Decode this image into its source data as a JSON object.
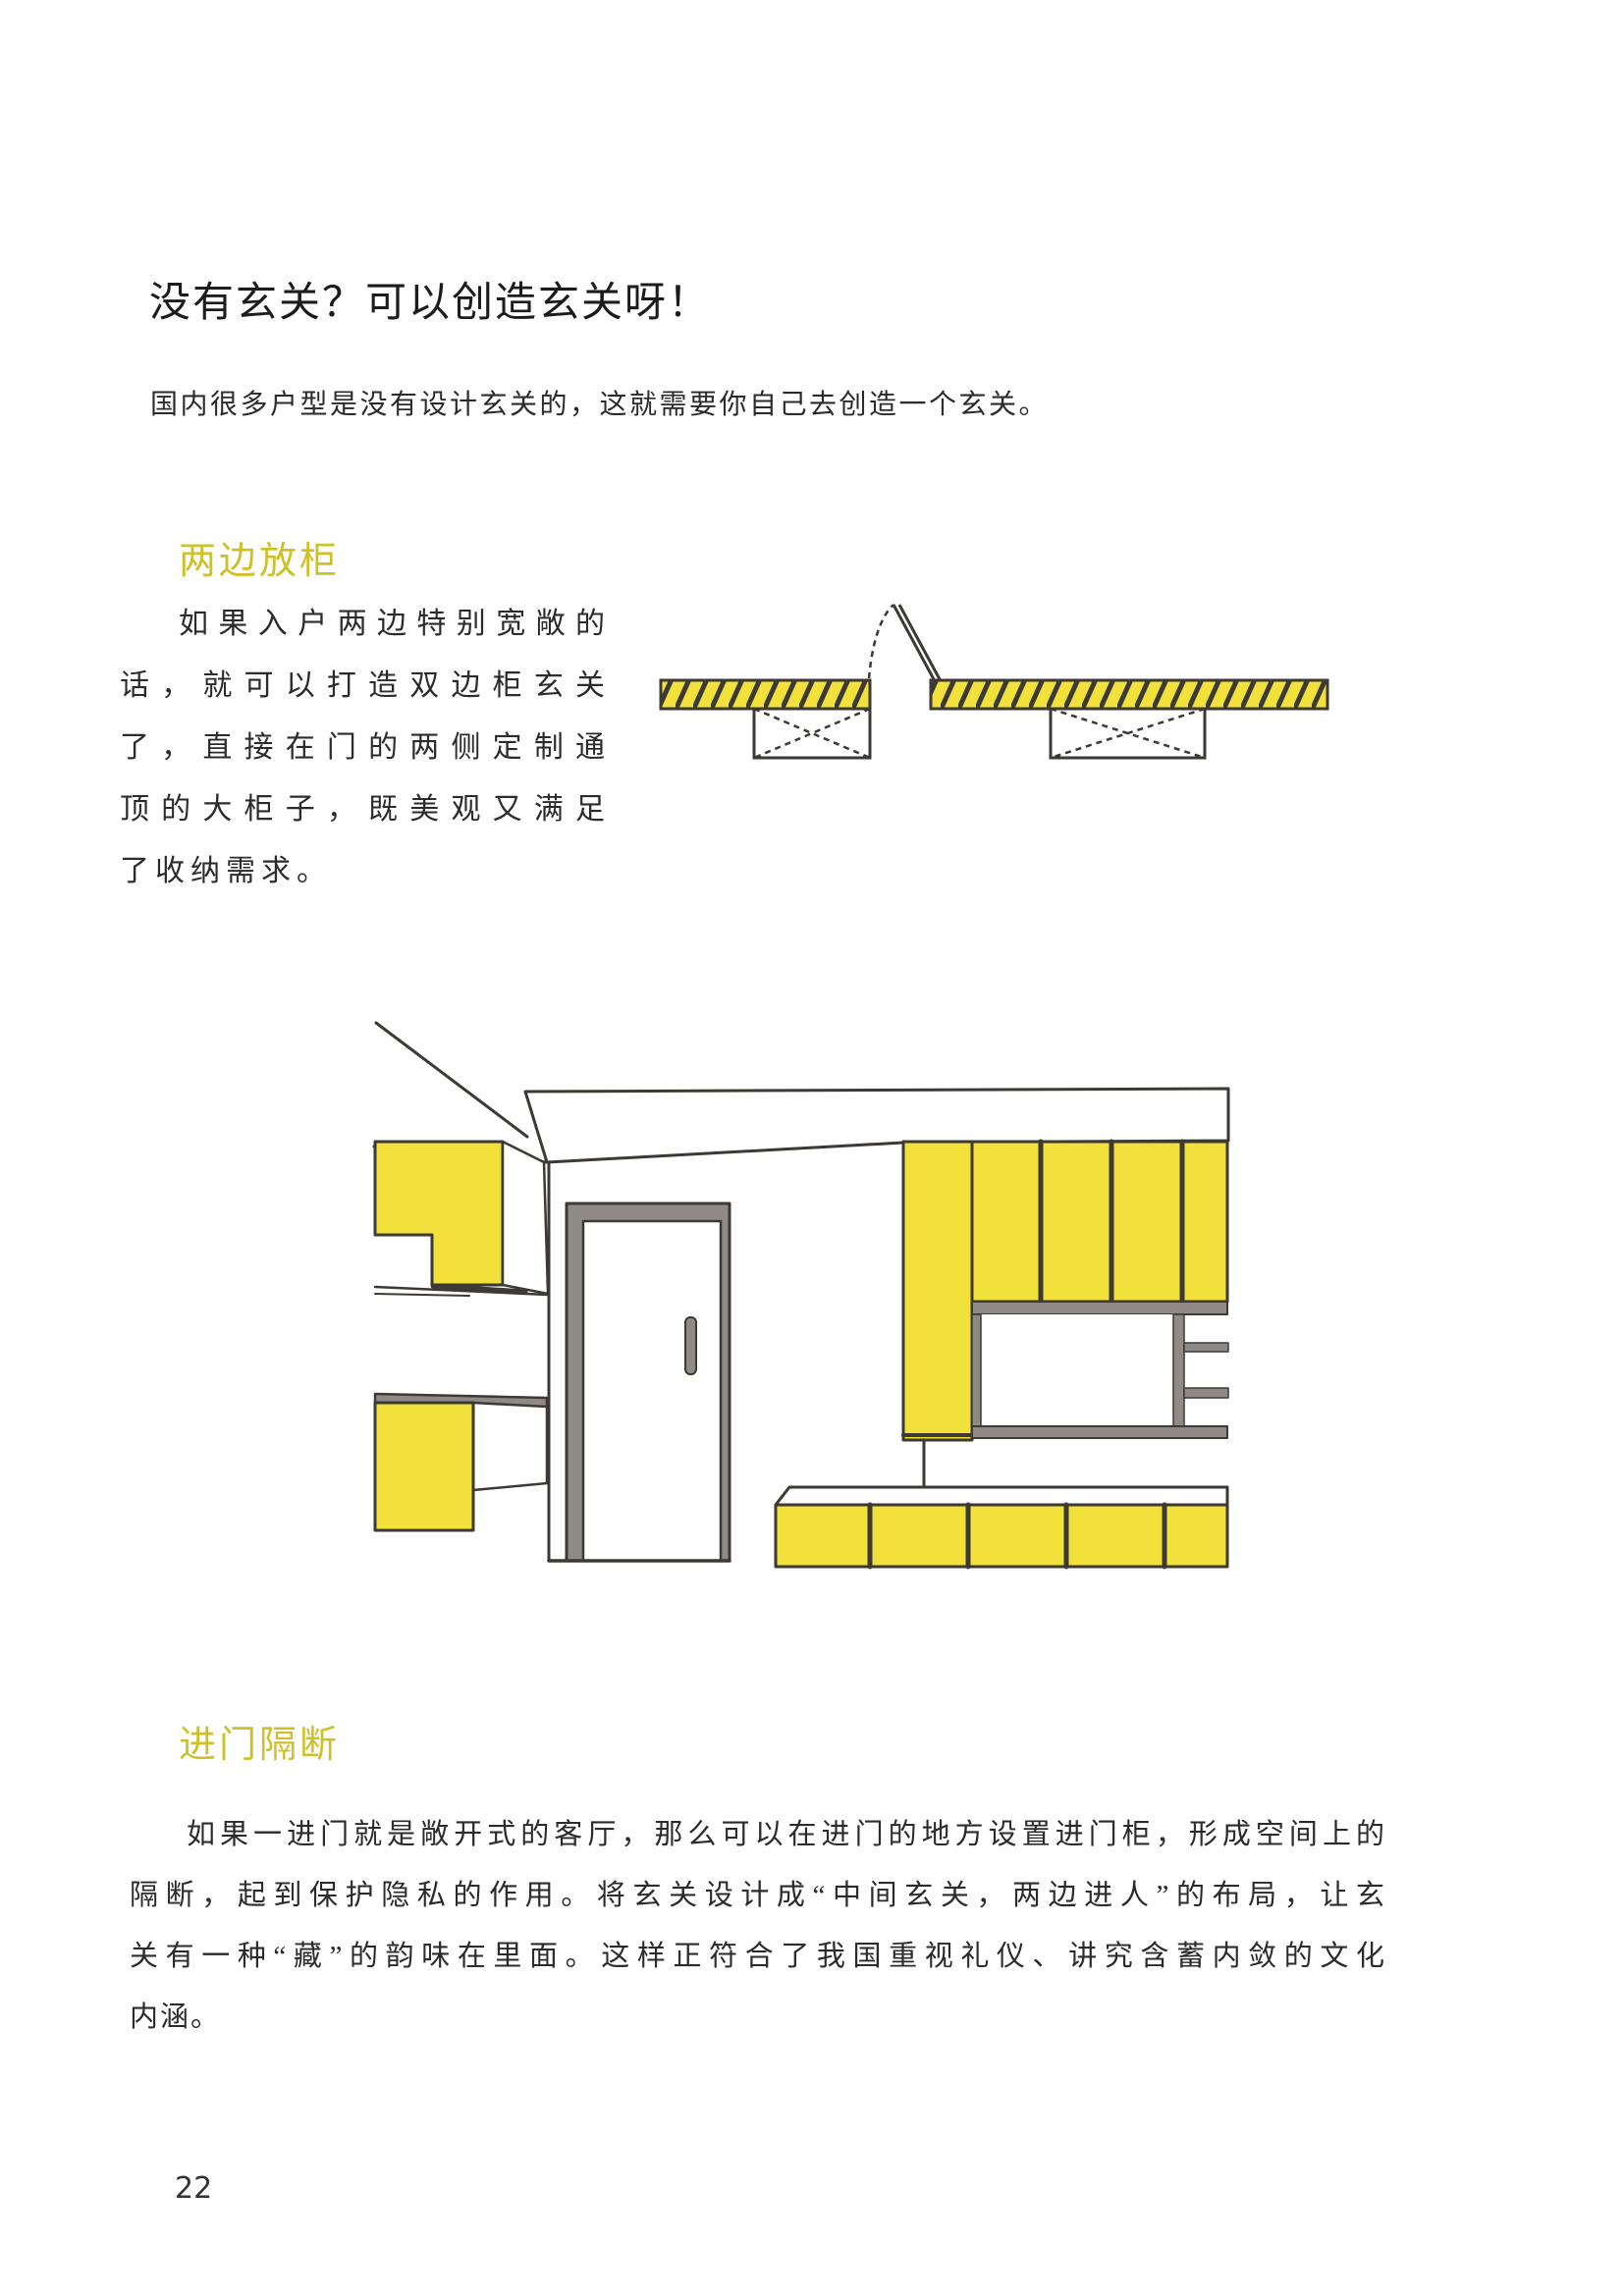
{
  "page": {
    "title": "没有玄关？可以创造玄关呀！",
    "intro": "国内很多户型是没有设计玄关的，这就需要你自己去创造一个玄关。",
    "page_number": "22"
  },
  "section1": {
    "heading": "两边放柜",
    "paragraph_lines": [
      "如果入户两边特别宽敞的",
      "话，就可以打造双边柜玄关",
      "了，直接在门的两侧定制通",
      "顶的大柜子，既美观又满足",
      "了收纳需求。"
    ]
  },
  "section2": {
    "heading": "进门隔断",
    "paragraph_lines": [
      "如果一进门就是敞开式的客厅，那么可以在进门的地方设置进门柜，形成空间上的",
      "隔断，起到保护隐私的作用。将玄关设计成“中间玄关，两边进人”的布局，让玄",
      "关有一种“藏”的韵味在里面。这样正符合了我国重视礼仪、讲究含蓄内敛的文化",
      "内涵。"
    ]
  },
  "colors": {
    "accent_yellow": "#f1e13a",
    "heading_yellow": "#cfc02a",
    "line_dark": "#3d3934",
    "gray": "#8f8a85"
  }
}
